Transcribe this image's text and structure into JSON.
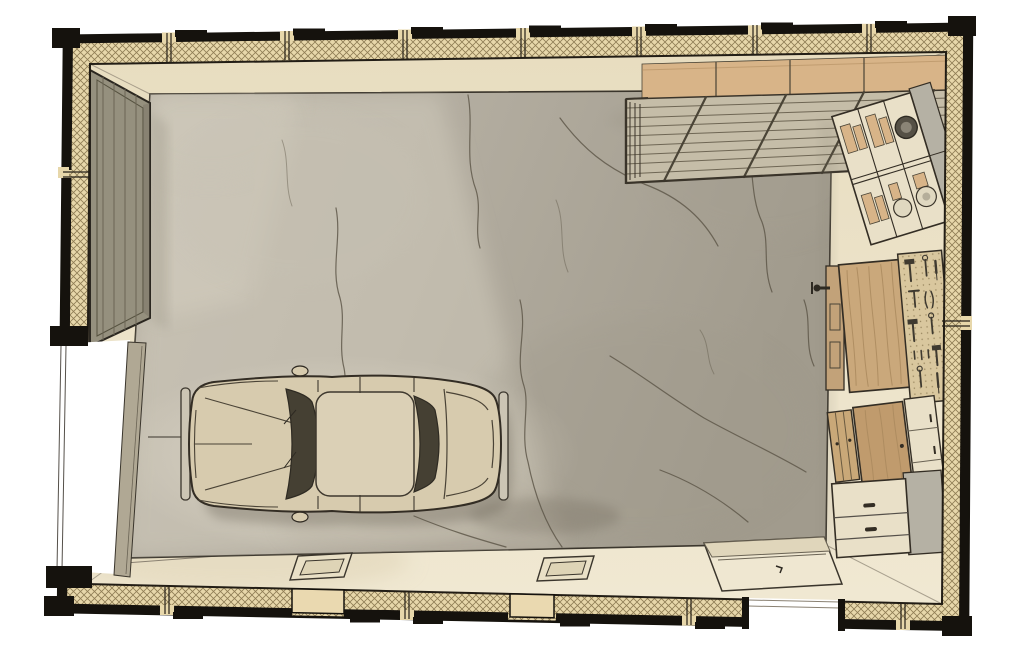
{
  "scene": {
    "type": "architectural-illustration",
    "title": "Garage floor plan (top-down hand-drawn illustration)",
    "room": "single-car garage",
    "objects": [
      {
        "id": "exterior-walls",
        "label": "Insulated walls with cross-hatched infill and stud breaks"
      },
      {
        "id": "garage-door-opening",
        "label": "Garage door opening, left wall"
      },
      {
        "id": "garage-door-panel",
        "label": "Vertical-plank door panel along upper-left wall"
      },
      {
        "id": "concrete-slab",
        "label": "Cracked concrete floor slab"
      },
      {
        "id": "car",
        "label": "Classic sedan parked, nose toward garage door"
      },
      {
        "id": "overhead-storage-rack",
        "label": "Suspended slatted storage rack with boxes, top-right"
      },
      {
        "id": "shelving-unit",
        "label": "Compartment shelving with cans, boxes and a tire, right wall"
      },
      {
        "id": "workbench",
        "label": "Wooden workbench with vise"
      },
      {
        "id": "pegboard",
        "label": "Pegboard of hand tools behind workbench"
      },
      {
        "id": "cabinet-group",
        "label": "Wood and painted cabinets, lower-right"
      },
      {
        "id": "base-cabinet",
        "label": "Two-drawer base cabinet with gray top"
      },
      {
        "id": "side-door-opening",
        "label": "Side door opening, bottom wall"
      },
      {
        "id": "door-landing",
        "label": "Entry landing pad at side door"
      },
      {
        "id": "floor-vent-left",
        "label": "Recessed floor vent near bottom wall (left)"
      },
      {
        "id": "floor-vent-center",
        "label": "Recessed floor vent near bottom wall (center)"
      },
      {
        "id": "wall-vent-left",
        "label": "Bottom-wall vent panel (left)"
      },
      {
        "id": "wall-vent-center",
        "label": "Bottom-wall vent panel (center)"
      }
    ]
  },
  "palette": {
    "page-bg": "#ffffff",
    "wall-black": "#15120d",
    "hatch-fill": "#e7d7aa",
    "hatch-line": "#8f7d55",
    "apron": "#ebe1c6",
    "slab": "#b3ada0",
    "slab-light": "#cdc7b9",
    "slab-dark": "#a29c8e",
    "crack": "#5f584a",
    "ink": "#2e2921",
    "car-body": "#d7cbae",
    "car-glass": "#454033",
    "door-panel": "#95907e",
    "wood": "#c8a376",
    "wood-dark": "#a9875c",
    "pegboard": "#d9c79e",
    "cream": "#e9e0c8",
    "gray-panel": "#b5b1a4",
    "box-tan": "#d8b488",
    "tool": "#3f3a30"
  }
}
